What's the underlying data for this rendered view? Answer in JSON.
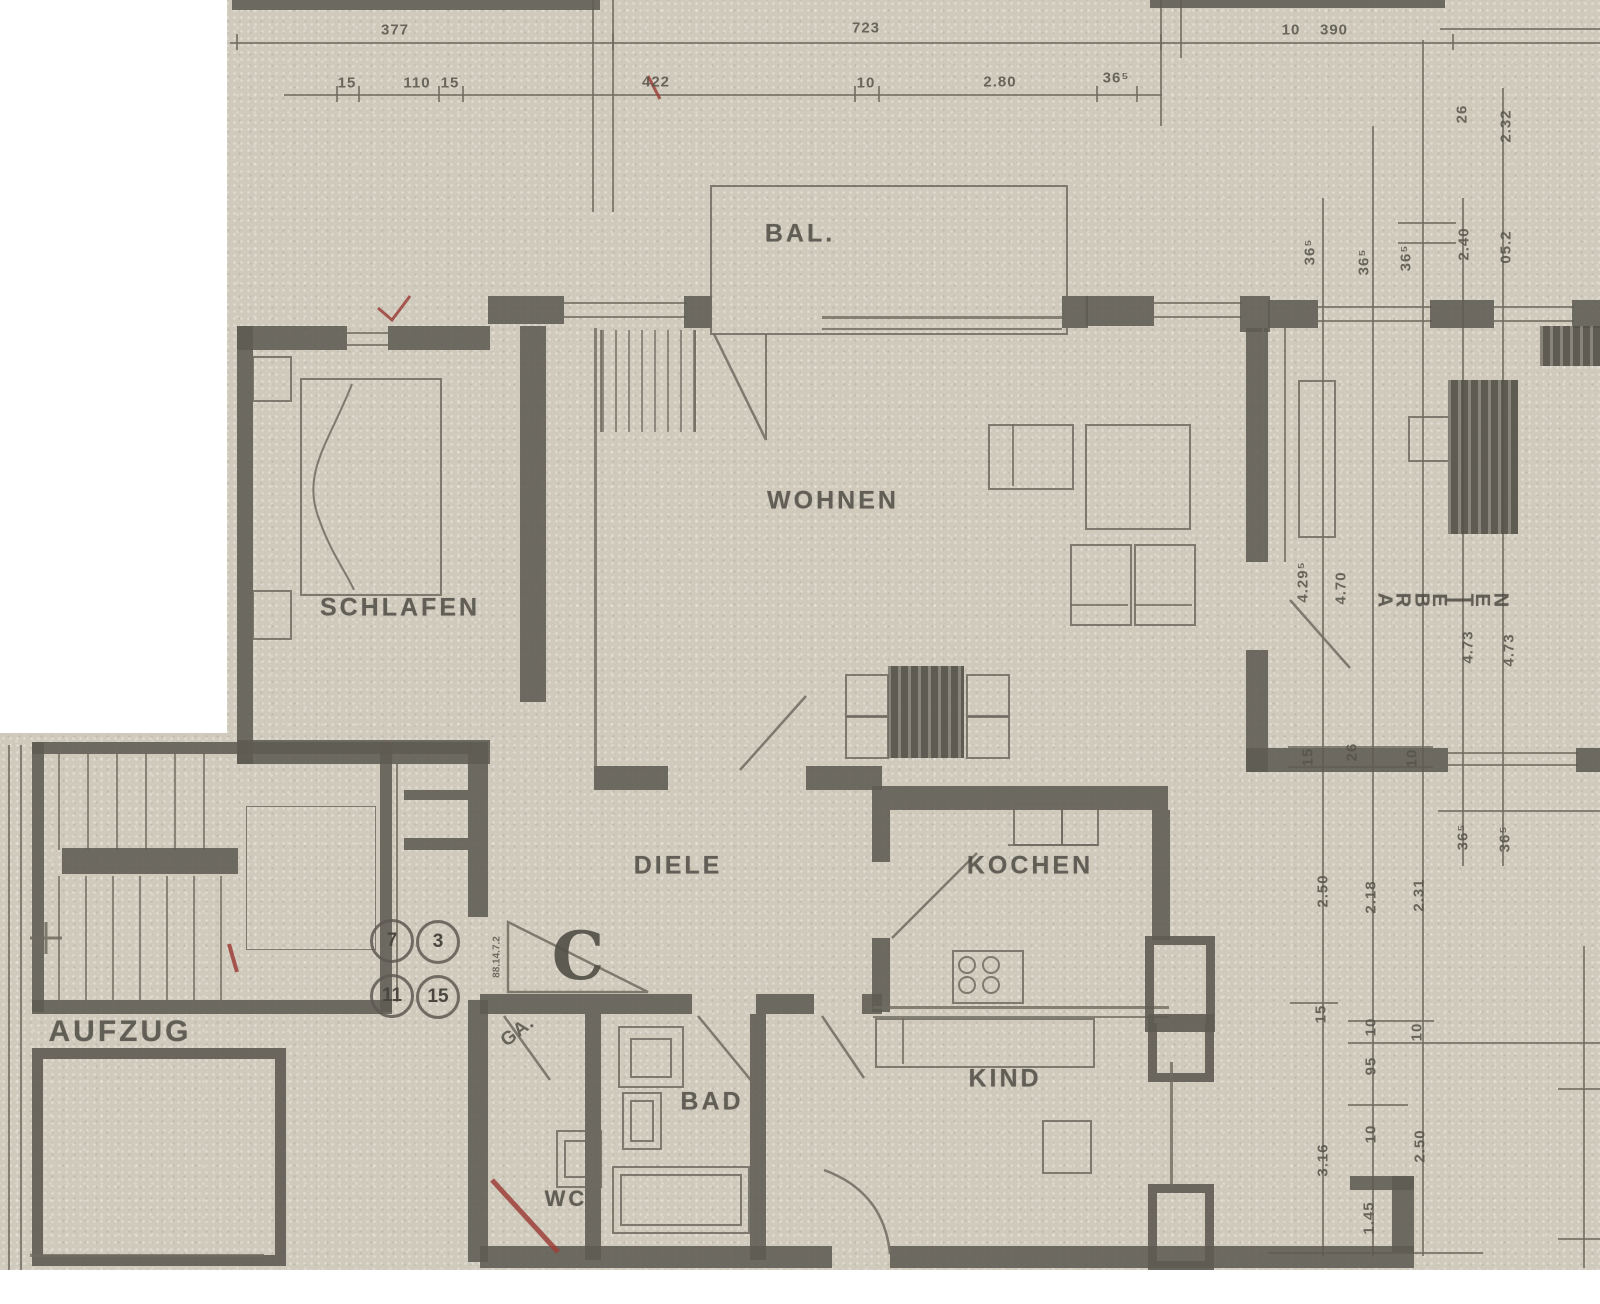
{
  "rooms": {
    "bal": "BAL.",
    "wohnen": "WOHNEN",
    "schlafen": "SCHLAFEN",
    "arbeiten": "ARBEITEN",
    "diele": "DIELE",
    "kochen": "KOCHEN",
    "bad": "BAD",
    "wc": "WC",
    "kind": "KIND",
    "aufzug": "AUFZUG"
  },
  "markers": {
    "section_letter": "C",
    "circle_numbers": [
      "7",
      "3",
      "11",
      "15"
    ],
    "corner_note": "GA.",
    "entry_dims": "88.14.7.2"
  },
  "dims": {
    "top_row": [
      "377",
      "723",
      "10",
      "390"
    ],
    "second_row": [
      "15",
      "110",
      "15",
      "422",
      "10",
      "2.80",
      "36⁵"
    ],
    "right_top": [
      "26",
      "2.32"
    ],
    "right_upper": [
      "36⁵",
      "36⁵",
      "36⁵",
      "2.40",
      "05.2"
    ],
    "right_mid": [
      "4.29⁵",
      "4.70",
      "4.73",
      "4.73"
    ],
    "right_chain": [
      "15",
      "26",
      "10"
    ],
    "right_band": [
      "36⁵",
      "36⁵"
    ],
    "right_heights": [
      "2.50",
      "2.18",
      "2.31"
    ],
    "right_lower": [
      "15",
      "10",
      "10",
      "95",
      "3.16",
      "10",
      "2.50",
      "1.45"
    ]
  },
  "colors": {
    "paper": "#cfcabc",
    "wall": "#5e5b53",
    "line": "#6f6b60",
    "red_mark": "#9c3f38"
  }
}
